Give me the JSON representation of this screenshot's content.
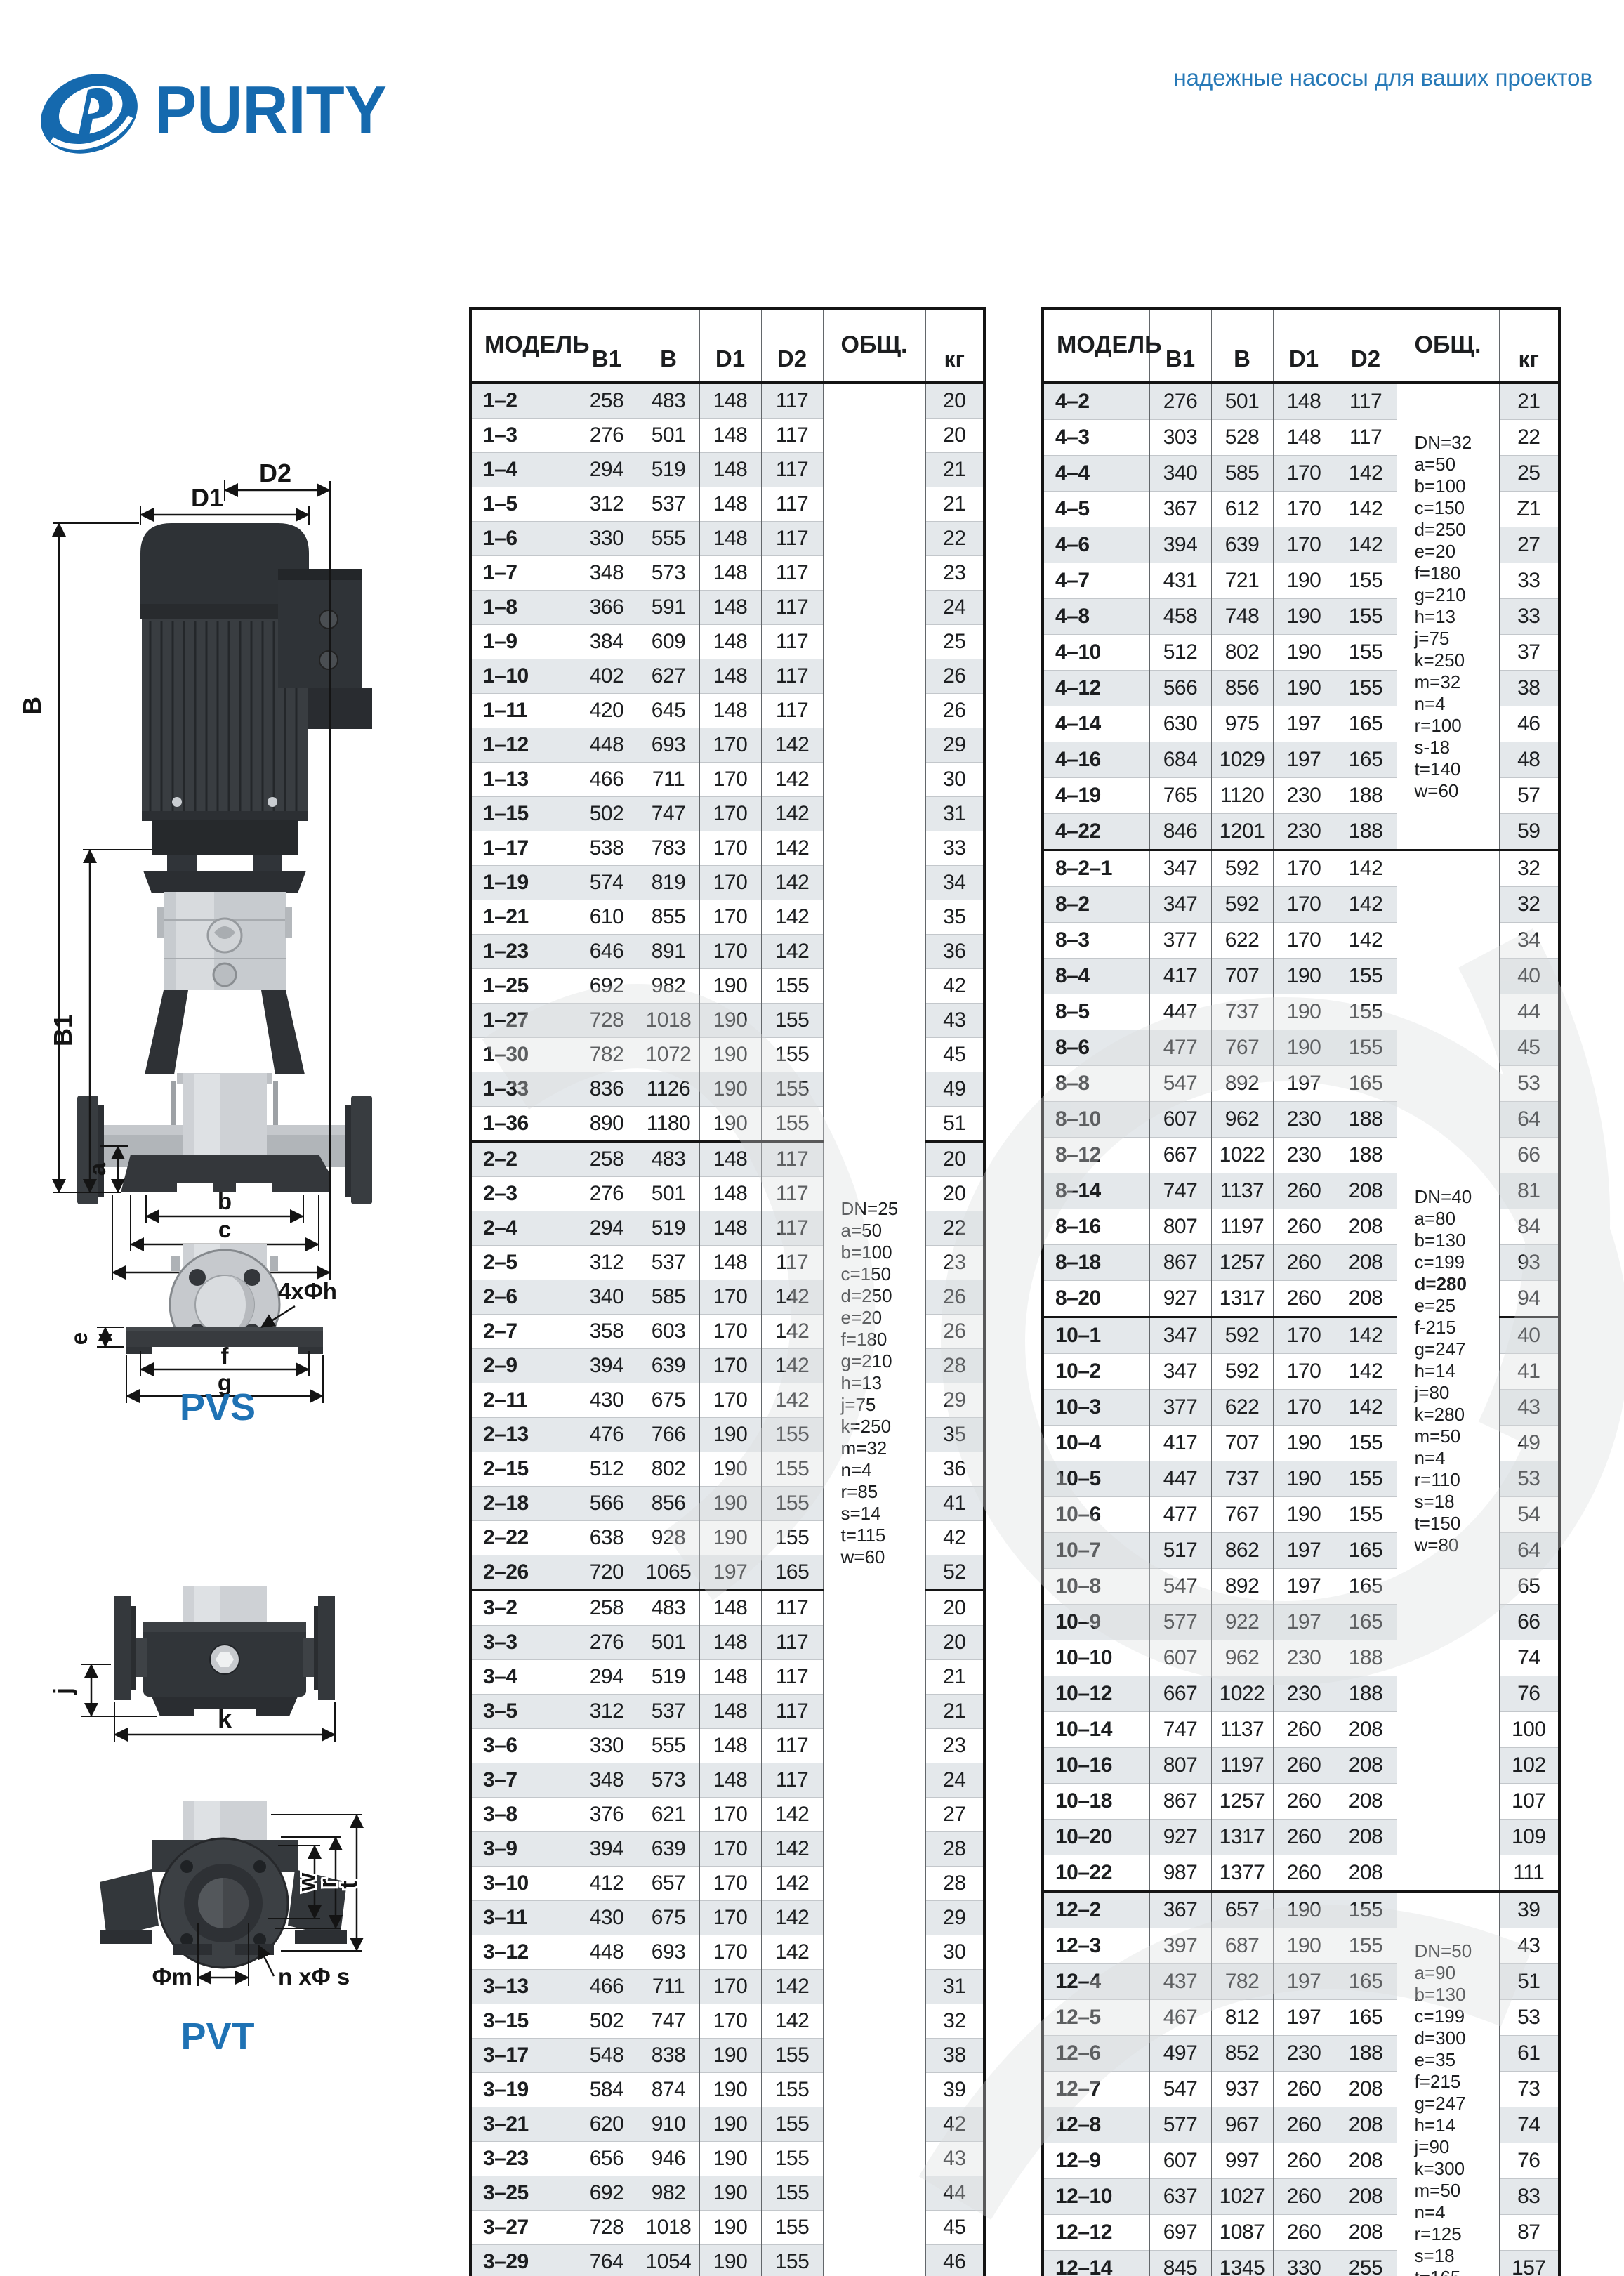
{
  "page": {
    "tagline": "надежные насосы для ваших проектов",
    "brand": "PURITY",
    "brand_color": "#1569ae",
    "accent_blue": "#1f72b4",
    "zebra_color": "#e4e8eb"
  },
  "diagram": {
    "pvs_label": "PVS",
    "pvt_label": "PVT",
    "labels": {
      "D2": "D2",
      "D1": "D1",
      "B": "B",
      "B1": "B1",
      "a": "a",
      "b": "b",
      "c": "c",
      "d": "d",
      "e": "e",
      "f": "f",
      "g": "g",
      "bolt_callout": "4xΦh",
      "j": "j",
      "k": "k",
      "w": "w",
      "r": "r",
      "t": "t",
      "fm": "Фm",
      "ns": "n xΦ s"
    }
  },
  "left_table": {
    "columns": [
      "МОДЕЛЬ",
      "B1",
      "B",
      "D1",
      "D2",
      "ОБЩ.",
      "кг"
    ],
    "groups": [
      {
        "rows": [
          [
            "1–2",
            "258",
            "483",
            "148",
            "117",
            "20"
          ],
          [
            "1–3",
            "276",
            "501",
            "148",
            "117",
            "20"
          ],
          [
            "1–4",
            "294",
            "519",
            "148",
            "117",
            "21"
          ],
          [
            "1–5",
            "312",
            "537",
            "148",
            "117",
            "21"
          ],
          [
            "1–6",
            "330",
            "555",
            "148",
            "117",
            "22"
          ],
          [
            "1–7",
            "348",
            "573",
            "148",
            "117",
            "23"
          ],
          [
            "1–8",
            "366",
            "591",
            "148",
            "117",
            "24"
          ],
          [
            "1–9",
            "384",
            "609",
            "148",
            "117",
            "25"
          ],
          [
            "1–10",
            "402",
            "627",
            "148",
            "117",
            "26"
          ],
          [
            "1–11",
            "420",
            "645",
            "148",
            "117",
            "26"
          ],
          [
            "1–12",
            "448",
            "693",
            "170",
            "142",
            "29"
          ],
          [
            "1–13",
            "466",
            "711",
            "170",
            "142",
            "30"
          ],
          [
            "1–15",
            "502",
            "747",
            "170",
            "142",
            "31"
          ],
          [
            "1–17",
            "538",
            "783",
            "170",
            "142",
            "33"
          ],
          [
            "1–19",
            "574",
            "819",
            "170",
            "142",
            "34"
          ],
          [
            "1–21",
            "610",
            "855",
            "170",
            "142",
            "35"
          ],
          [
            "1–23",
            "646",
            "891",
            "170",
            "142",
            "36"
          ],
          [
            "1–25",
            "692",
            "982",
            "190",
            "155",
            "42"
          ],
          [
            "1–27",
            "728",
            "1018",
            "190",
            "155",
            "43"
          ],
          [
            "1–30",
            "782",
            "1072",
            "190",
            "155",
            "45"
          ],
          [
            "1–33",
            "836",
            "1126",
            "190",
            "155",
            "49"
          ],
          [
            "1–36",
            "890",
            "1180",
            "190",
            "155",
            "51"
          ]
        ]
      },
      {
        "rows": [
          [
            "2–2",
            "258",
            "483",
            "148",
            "117",
            "20"
          ],
          [
            "2–3",
            "276",
            "501",
            "148",
            "117",
            "20"
          ],
          [
            "2–4",
            "294",
            "519",
            "148",
            "117",
            "22"
          ],
          [
            "2–5",
            "312",
            "537",
            "148",
            "117",
            "23"
          ],
          [
            "2–6",
            "340",
            "585",
            "170",
            "142",
            "26"
          ],
          [
            "2–7",
            "358",
            "603",
            "170",
            "142",
            "26"
          ],
          [
            "2–9",
            "394",
            "639",
            "170",
            "142",
            "28"
          ],
          [
            "2–11",
            "430",
            "675",
            "170",
            "142",
            "29"
          ],
          [
            "2–13",
            "476",
            "766",
            "190",
            "155",
            "35"
          ],
          [
            "2–15",
            "512",
            "802",
            "190",
            "155",
            "36"
          ],
          [
            "2–18",
            "566",
            "856",
            "190",
            "155",
            "41"
          ],
          [
            "2–22",
            "638",
            "928",
            "190",
            "155",
            "42"
          ],
          [
            "2–26",
            "720",
            "1065",
            "197",
            "165",
            "52"
          ]
        ]
      },
      {
        "rows": [
          [
            "3–2",
            "258",
            "483",
            "148",
            "117",
            "20"
          ],
          [
            "3–3",
            "276",
            "501",
            "148",
            "117",
            "20"
          ],
          [
            "3–4",
            "294",
            "519",
            "148",
            "117",
            "21"
          ],
          [
            "3–5",
            "312",
            "537",
            "148",
            "117",
            "21"
          ],
          [
            "3–6",
            "330",
            "555",
            "148",
            "117",
            "23"
          ],
          [
            "3–7",
            "348",
            "573",
            "148",
            "117",
            "24"
          ],
          [
            "3–8",
            "376",
            "621",
            "170",
            "142",
            "27"
          ],
          [
            "3–9",
            "394",
            "639",
            "170",
            "142",
            "28"
          ],
          [
            "3–10",
            "412",
            "657",
            "170",
            "142",
            "28"
          ],
          [
            "3–11",
            "430",
            "675",
            "170",
            "142",
            "29"
          ],
          [
            "3–12",
            "448",
            "693",
            "170",
            "142",
            "30"
          ],
          [
            "3–13",
            "466",
            "711",
            "170",
            "142",
            "31"
          ],
          [
            "3–15",
            "502",
            "747",
            "170",
            "142",
            "32"
          ],
          [
            "3–17",
            "548",
            "838",
            "190",
            "155",
            "38"
          ],
          [
            "3–19",
            "584",
            "874",
            "190",
            "155",
            "39"
          ],
          [
            "3–21",
            "620",
            "910",
            "190",
            "155",
            "42"
          ],
          [
            "3–23",
            "656",
            "946",
            "190",
            "155",
            "43"
          ],
          [
            "3–25",
            "692",
            "982",
            "190",
            "155",
            "44"
          ],
          [
            "3–27",
            "728",
            "1018",
            "190",
            "155",
            "45"
          ],
          [
            "3–29",
            "764",
            "1054",
            "190",
            "155",
            "46"
          ],
          [
            "3–31",
            "810",
            "1155",
            "197",
            "165",
            "54"
          ],
          [
            "3–33",
            "846",
            "1191",
            "197",
            "165",
            "55"
          ],
          [
            "3–36",
            "900",
            "1245",
            "197",
            "165",
            "57"
          ]
        ]
      }
    ],
    "obsh_cells": [
      {
        "row": 0,
        "span": 58,
        "lines": [
          "DN=25",
          "a=50",
          "b=100",
          "c=150",
          "d=250",
          "e=20",
          "f=180",
          "g=210",
          "h=13",
          "j=75",
          "k=250",
          "m=32",
          "n=4",
          "r=85",
          "s=14",
          "t=115",
          "w=60"
        ]
      }
    ]
  },
  "right_table": {
    "columns": [
      "МОДЕЛЬ",
      "B1",
      "B",
      "D1",
      "D2",
      "ОБЩ.",
      "кг"
    ],
    "groups": [
      {
        "rows": [
          [
            "4–2",
            "276",
            "501",
            "148",
            "117",
            "21"
          ],
          [
            "4–3",
            "303",
            "528",
            "148",
            "117",
            "22"
          ],
          [
            "4–4",
            "340",
            "585",
            "170",
            "142",
            "25"
          ],
          [
            "4–5",
            "367",
            "612",
            "170",
            "142",
            "Z1"
          ],
          [
            "4–6",
            "394",
            "639",
            "170",
            "142",
            "27"
          ],
          [
            "4–7",
            "431",
            "721",
            "190",
            "155",
            "33"
          ],
          [
            "4–8",
            "458",
            "748",
            "190",
            "155",
            "33"
          ],
          [
            "4–10",
            "512",
            "802",
            "190",
            "155",
            "37"
          ],
          [
            "4–12",
            "566",
            "856",
            "190",
            "155",
            "38"
          ],
          [
            "4–14",
            "630",
            "975",
            "197",
            "165",
            "46"
          ],
          [
            "4–16",
            "684",
            "1029",
            "197",
            "165",
            "48"
          ],
          [
            "4–19",
            "765",
            "1120",
            "230",
            "188",
            "57"
          ],
          [
            "4–22",
            "846",
            "1201",
            "230",
            "188",
            "59"
          ]
        ]
      },
      {
        "rows": [
          [
            "8–2–1",
            "347",
            "592",
            "170",
            "142",
            "32"
          ],
          [
            "8–2",
            "347",
            "592",
            "170",
            "142",
            "32"
          ],
          [
            "8–3",
            "377",
            "622",
            "170",
            "142",
            "34"
          ],
          [
            "8–4",
            "417",
            "707",
            "190",
            "155",
            "40"
          ],
          [
            "8–5",
            "447",
            "737",
            "190",
            "155",
            "44"
          ],
          [
            "8–6",
            "477",
            "767",
            "190",
            "155",
            "45"
          ],
          [
            "8–8",
            "547",
            "892",
            "197",
            "165",
            "53"
          ],
          [
            "8–10",
            "607",
            "962",
            "230",
            "188",
            "64"
          ],
          [
            "8–12",
            "667",
            "1022",
            "230",
            "188",
            "66"
          ],
          [
            "8–14",
            "747",
            "1137",
            "260",
            "208",
            "81"
          ],
          [
            "8–16",
            "807",
            "1197",
            "260",
            "208",
            "84"
          ],
          [
            "8–18",
            "867",
            "1257",
            "260",
            "208",
            "93"
          ],
          [
            "8–20",
            "927",
            "1317",
            "260",
            "208",
            "94"
          ]
        ]
      },
      {
        "rows": [
          [
            "10–1",
            "347",
            "592",
            "170",
            "142",
            "40"
          ],
          [
            "10–2",
            "347",
            "592",
            "170",
            "142",
            "41"
          ],
          [
            "10–3",
            "377",
            "622",
            "170",
            "142",
            "43"
          ],
          [
            "10–4",
            "417",
            "707",
            "190",
            "155",
            "49"
          ],
          [
            "10–5",
            "447",
            "737",
            "190",
            "155",
            "53"
          ],
          [
            "10–6",
            "477",
            "767",
            "190",
            "155",
            "54"
          ],
          [
            "10–7",
            "517",
            "862",
            "197",
            "165",
            "64"
          ],
          [
            "10–8",
            "547",
            "892",
            "197",
            "165",
            "65"
          ],
          [
            "10–9",
            "577",
            "922",
            "197",
            "165",
            "66"
          ],
          [
            "10–10",
            "607",
            "962",
            "230",
            "188",
            "74"
          ],
          [
            "10–12",
            "667",
            "1022",
            "230",
            "188",
            "76"
          ],
          [
            "10–14",
            "747",
            "1137",
            "260",
            "208",
            "100"
          ],
          [
            "10–16",
            "807",
            "1197",
            "260",
            "208",
            "102"
          ],
          [
            "10–18",
            "867",
            "1257",
            "260",
            "208",
            "107"
          ],
          [
            "10–20",
            "927",
            "1317",
            "260",
            "208",
            "109"
          ],
          [
            "10–22",
            "987",
            "1377",
            "260",
            "208",
            "111"
          ]
        ]
      },
      {
        "rows": [
          [
            "12–2",
            "367",
            "657",
            "190",
            "155",
            "39"
          ],
          [
            "12–3",
            "397",
            "687",
            "190",
            "155",
            "43"
          ],
          [
            "12–4",
            "437",
            "782",
            "197",
            "165",
            "51"
          ],
          [
            "12–5",
            "467",
            "812",
            "197",
            "165",
            "53"
          ],
          [
            "12–6",
            "497",
            "852",
            "230",
            "188",
            "61"
          ],
          [
            "12–7",
            "547",
            "937",
            "260",
            "208",
            "73"
          ],
          [
            "12–8",
            "577",
            "967",
            "260",
            "208",
            "74"
          ],
          [
            "12–9",
            "607",
            "997",
            "260",
            "208",
            "76"
          ],
          [
            "12–10",
            "637",
            "1027",
            "260",
            "208",
            "83"
          ],
          [
            "12–12",
            "697",
            "1087",
            "260",
            "208",
            "87"
          ],
          [
            "12–14",
            "845",
            "1345",
            "330",
            "255",
            "157"
          ],
          [
            "12–16",
            "905",
            "1405",
            "330",
            "255",
            "161"
          ],
          [
            "12–18",
            "965",
            "1465",
            "330",
            "255",
            "164"
          ]
        ]
      }
    ],
    "obsh_cells": [
      {
        "row": 0,
        "span": 13,
        "lines": [
          "DN=32",
          "a=50",
          "b=100",
          "c=150",
          "d=250",
          "e=20",
          "f=180",
          "g=210",
          "h=13",
          "j=75",
          "k=250",
          "m=32",
          "n=4",
          "r=100",
          "s-18",
          "t=140",
          "w=60"
        ]
      },
      {
        "row": 13,
        "span": 29,
        "bold_line": 4,
        "lines": [
          "DN=40",
          "a=80",
          "b=130",
          "c=199",
          "d=280",
          "e=25",
          "f-215",
          "g=247",
          "h=14",
          "j=80",
          "k=280",
          "m=50",
          "n=4",
          "r=110",
          "s=18",
          "t=150",
          "w=80"
        ]
      },
      {
        "row": 42,
        "span": 13,
        "lines": [
          "DN=50",
          "a=90",
          "b=130",
          "c=199",
          "d=300",
          "e=35",
          "f=215",
          "g=247",
          "h=14",
          "j=90",
          "k=300",
          "m=50",
          "n=4",
          "r=125",
          "s=18",
          "t=165",
          "w=80"
        ]
      }
    ]
  }
}
